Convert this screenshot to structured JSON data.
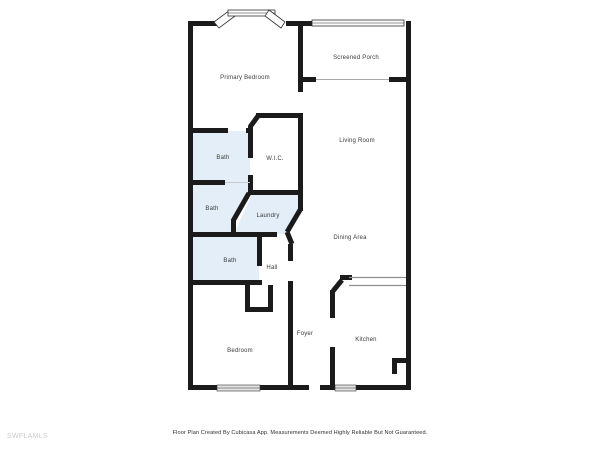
{
  "floor_plan": {
    "rooms": [
      {
        "id": "primary-bedroom",
        "label": "Primary Bedroom"
      },
      {
        "id": "screened-porch",
        "label": "Screened Porch"
      },
      {
        "id": "living-room",
        "label": "Living Room"
      },
      {
        "id": "dining-area",
        "label": "Dining Area"
      },
      {
        "id": "kitchen",
        "label": "Kitchen"
      },
      {
        "id": "foyer",
        "label": "Foyer"
      },
      {
        "id": "bedroom",
        "label": "Bedroom"
      },
      {
        "id": "hall",
        "label": "Hall"
      },
      {
        "id": "bath-upper",
        "label": "Bath"
      },
      {
        "id": "bath-middle",
        "label": "Bath"
      },
      {
        "id": "bath-lower",
        "label": "Bath"
      },
      {
        "id": "wic",
        "label": "W.I.C."
      },
      {
        "id": "laundry",
        "label": "Laundry"
      }
    ],
    "footer": {
      "watermark": "SWFLAMLS",
      "disclaimer": "Floor Plan Created By Cubicasa App. Measurements Deemed Highly Reliable But Not Guaranteed."
    },
    "colors": {
      "wall": "#1b1b1b",
      "wet_room_fill": "#e3eef8",
      "window_fill": "#ececec",
      "label_text": "#3a3a3a",
      "watermark_text": "#cbcbcb"
    }
  }
}
